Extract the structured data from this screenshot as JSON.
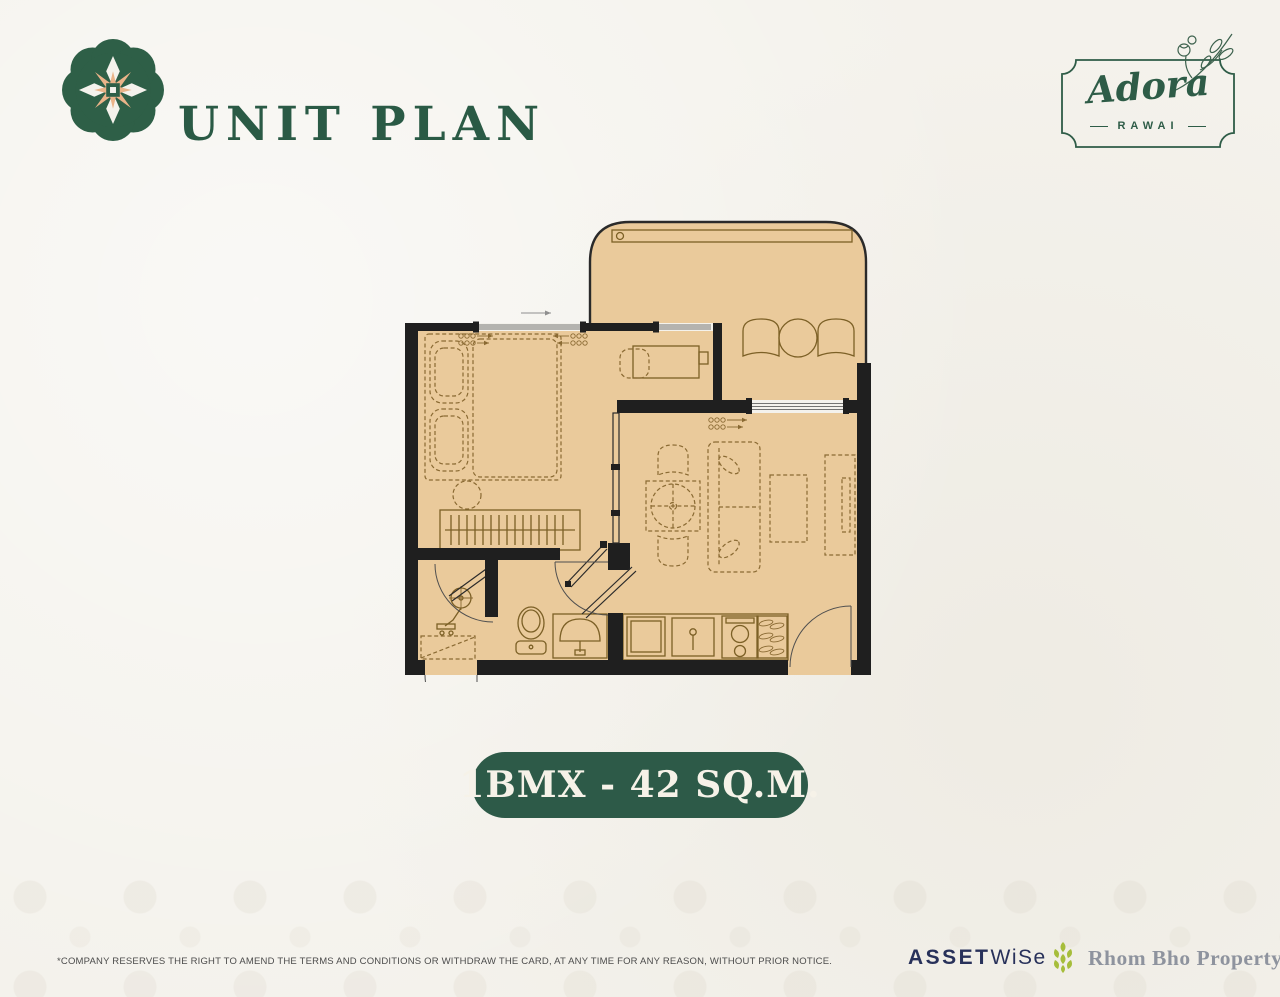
{
  "header": {
    "title": "UNIT PLAN",
    "badge": {
      "name": "Adora",
      "location": "RAWAI"
    }
  },
  "unit_label": {
    "text": "1BMX - 42 SQ.M.",
    "background": "#2d5a48",
    "text_color": "#f6f2e8"
  },
  "floorplan": {
    "floor_fill": "#eaca9b",
    "wall_color": "#1f1f1f",
    "furniture_line_color": "#8a6a33",
    "areas": [
      "balcony",
      "bedroom",
      "living-dining",
      "kitchen",
      "bathroom",
      "hallway"
    ],
    "furniture_icons": [
      "planter-box",
      "balcony-chair",
      "balcony-round-table",
      "double-bed",
      "pillow",
      "bedside-table",
      "wardrobe-hanging-rail",
      "work-desk",
      "desk-chair",
      "sliding-glass-partition",
      "dining-round-table",
      "dining-chair",
      "sofa",
      "coffee-table",
      "tv-console",
      "refrigerator",
      "kitchen-sink",
      "two-burner-stove",
      "shoe-shelf",
      "entrance-door",
      "bathroom-door",
      "shower-set",
      "toilet",
      "wash-basin",
      "utility-closet"
    ]
  },
  "footer": {
    "disclaimer": "*COMPANY RESERVES THE RIGHT TO AMEND THE TERMS AND CONDITIONS OR WITHDRAW THE CARD, AT ANY TIME FOR ANY REASON, WITHOUT PRIOR NOTICE.",
    "assetwise": {
      "part1": "ASSET",
      "part2": "WiSe"
    },
    "partner": "Rhom Bho Property"
  },
  "colors": {
    "green_dark": "#2d5a48",
    "green_logo": "#2e5f47",
    "peach": "#eab389",
    "tan_floor": "#eaca9b",
    "wall": "#1f1f1f",
    "navy": "#28315a",
    "partner_gray": "#8e939e",
    "leaf_green": "#a6bd3b",
    "background": "#f4f2ec"
  }
}
